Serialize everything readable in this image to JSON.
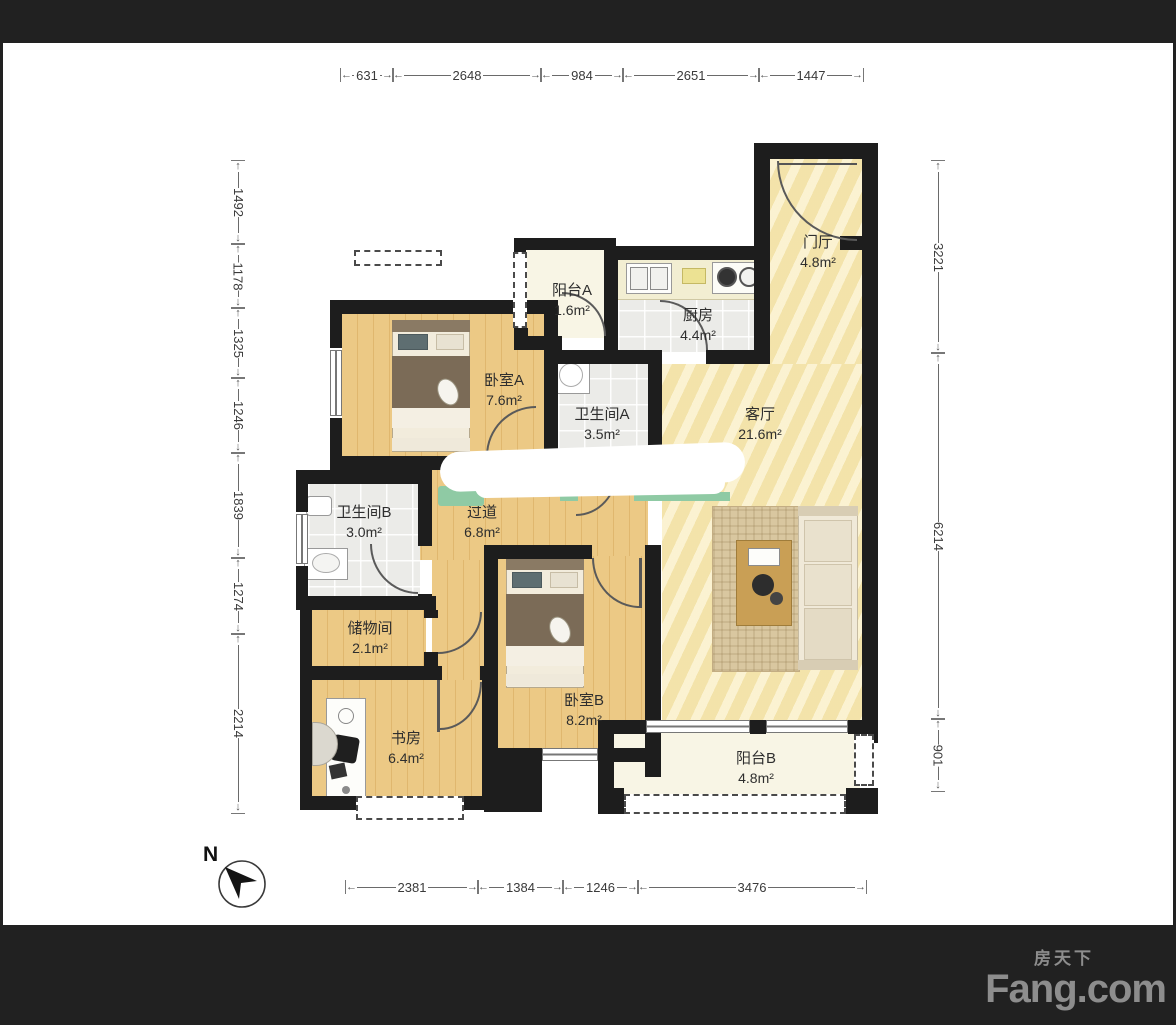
{
  "meta": {
    "compass_label": "N"
  },
  "rooms": [
    {
      "id": "entry",
      "name": "门厅",
      "area": "4.8m²"
    },
    {
      "id": "kitchen",
      "name": "厨房",
      "area": "4.4m²"
    },
    {
      "id": "balcony_a",
      "name": "阳台A",
      "area": "1.6m²"
    },
    {
      "id": "bedroom_a",
      "name": "卧室A",
      "area": "7.6m²"
    },
    {
      "id": "bath_a",
      "name": "卫生间A",
      "area": "3.5m²"
    },
    {
      "id": "living",
      "name": "客厅",
      "area": "21.6m²"
    },
    {
      "id": "hallway",
      "name": "过道",
      "area": "6.8m²"
    },
    {
      "id": "bath_b",
      "name": "卫生间B",
      "area": "3.0m²"
    },
    {
      "id": "storage",
      "name": "储物间",
      "area": "2.1m²"
    },
    {
      "id": "study",
      "name": "书房",
      "area": "6.4m²"
    },
    {
      "id": "bedroom_b",
      "name": "卧室B",
      "area": "8.2m²"
    },
    {
      "id": "balcony_b",
      "name": "阳台B",
      "area": "4.8m²"
    }
  ],
  "dimensions": {
    "top": [
      "631",
      "2648",
      "984",
      "2651",
      "1447"
    ],
    "bottom": [
      "2381",
      "1384",
      "1246",
      "3476"
    ],
    "left": [
      "1492",
      "1178",
      "1325",
      "1246",
      "1839",
      "1274",
      "2214"
    ],
    "right": [
      "3221",
      "6214",
      "901"
    ]
  },
  "branding": {
    "logo_cn": "房天下",
    "logo_en": "Fang.com"
  }
}
